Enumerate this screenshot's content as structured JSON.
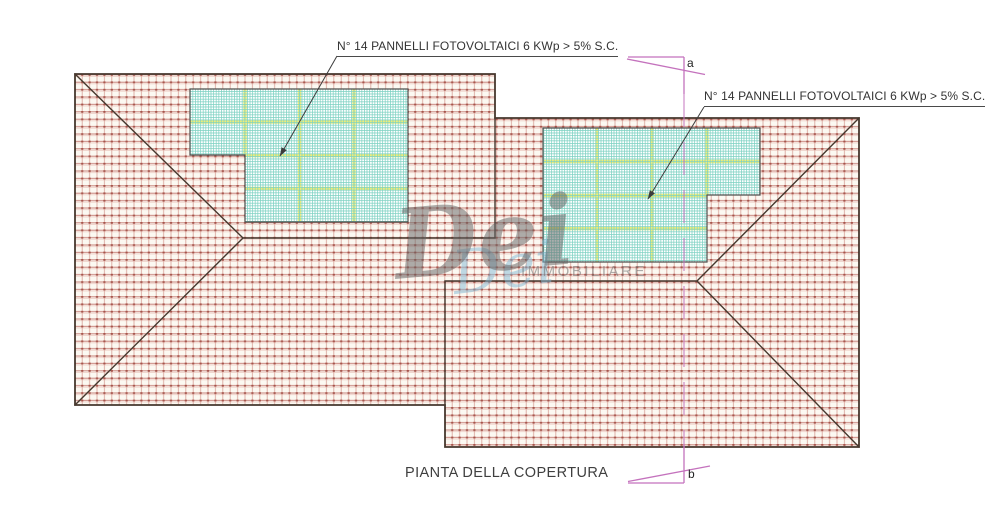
{
  "plan": {
    "title": "PIANTA DELLA COPERTURA",
    "panel_label_left": "N° 14 PANNELLI FOTOVOLTAICI 6 KWp > 5% S.C.",
    "panel_label_right": "N° 14 PANNELLI FOTOVOLTAICI 6 KWp > 5% S.C.",
    "section_letter_top": "a",
    "section_letter_bottom": "b"
  },
  "watermark": {
    "script": "Dei",
    "subtext": "IMMOBILIARE"
  },
  "colors": {
    "roof_hatch_line": "#c8837b",
    "roof_hatch_dark": "#a5544b",
    "roof_outline": "#46382e",
    "panel_mesh": "#7ed2c3",
    "panel_separator": "#f2ee76",
    "panel_outline": "#4f4f4d",
    "section_line": "#c472bd",
    "label_text": "#333333"
  }
}
